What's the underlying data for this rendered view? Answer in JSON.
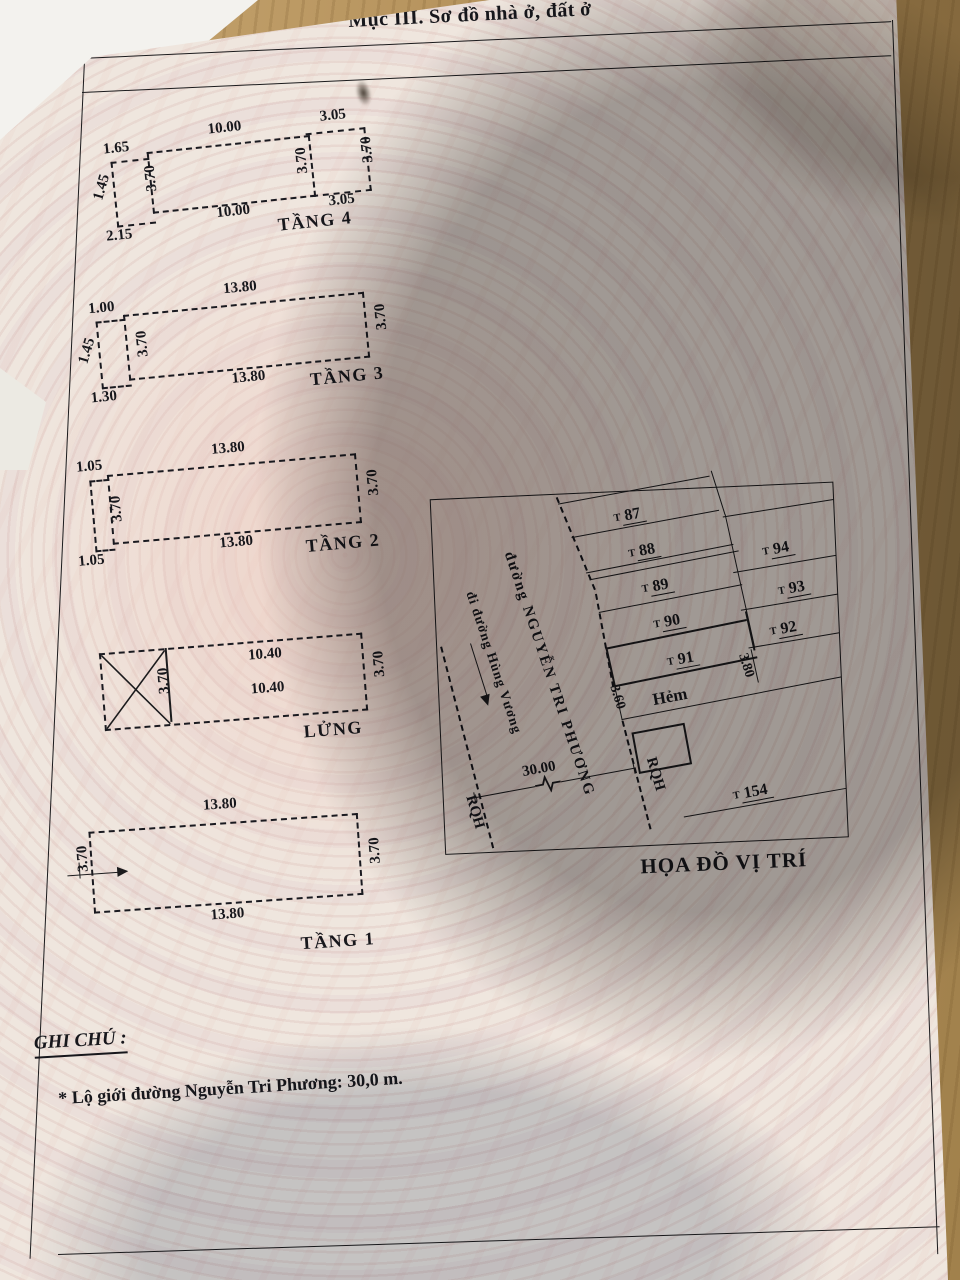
{
  "colors": {
    "paper": "#efe6de",
    "ink": "#1b1b1d",
    "wood": "#b5925c",
    "shadow": "#585654"
  },
  "header": {
    "title": "Mục III. Sơ đồ nhà ở, đất ở"
  },
  "plans": {
    "tang4": {
      "label": "TẦNG 4",
      "main_top": "10.00",
      "main_bottom": "10.00",
      "side_left": "3.70",
      "side_right": "3.70",
      "ext_right_top": "3.05",
      "ext_right_bottom": "3.05",
      "ext_right_side": "3.70",
      "ext_left_top": "1.65",
      "ext_left_side": "1.45",
      "ext_left_bottom": "2.15"
    },
    "tang3": {
      "label": "TẦNG 3",
      "main_top": "13.80",
      "main_bottom": "13.80",
      "side_left": "3.70",
      "side_right": "3.70",
      "ext_left_top": "1.00",
      "ext_left_side": "1.45",
      "ext_left_bottom": "1.30"
    },
    "tang2": {
      "label": "TẦNG 2",
      "main_top": "13.80",
      "main_bottom": "13.80",
      "side_left": "3.70",
      "side_right": "3.70",
      "ext_left_top": "1.05",
      "ext_left_bottom": "1.05"
    },
    "lung": {
      "label": "LỬNG",
      "main_top": "10.40",
      "main_bottom": "10.40",
      "divider": "3.70",
      "side_right": "3.70"
    },
    "tang1": {
      "label": "TẦNG 1",
      "main_top": "13.80",
      "main_bottom": "13.80",
      "side_left": "3.70",
      "side_right": "3.70"
    }
  },
  "map": {
    "title": "HỌA ĐỒ VỊ TRÍ",
    "street_main": "đường NGUYỄN TRI PHƯƠNG",
    "street_sub": "đi đường Hùng Vương",
    "road_width": "30.00",
    "alley_label": "Hẻm",
    "alley_left": "3.60",
    "alley_right": "3.80",
    "rqh_left": "RQH",
    "rqh_mid": "RQH",
    "lot_prefix": "T",
    "lots_left": [
      "87",
      "88",
      "89",
      "90",
      "91"
    ],
    "lots_right": [
      "94",
      "93",
      "92"
    ],
    "lot_bottom": "154"
  },
  "notes": {
    "heading": "GHI CHÚ :",
    "line1": "* Lộ giới đường Nguyễn Tri Phương: 30,0 m."
  }
}
